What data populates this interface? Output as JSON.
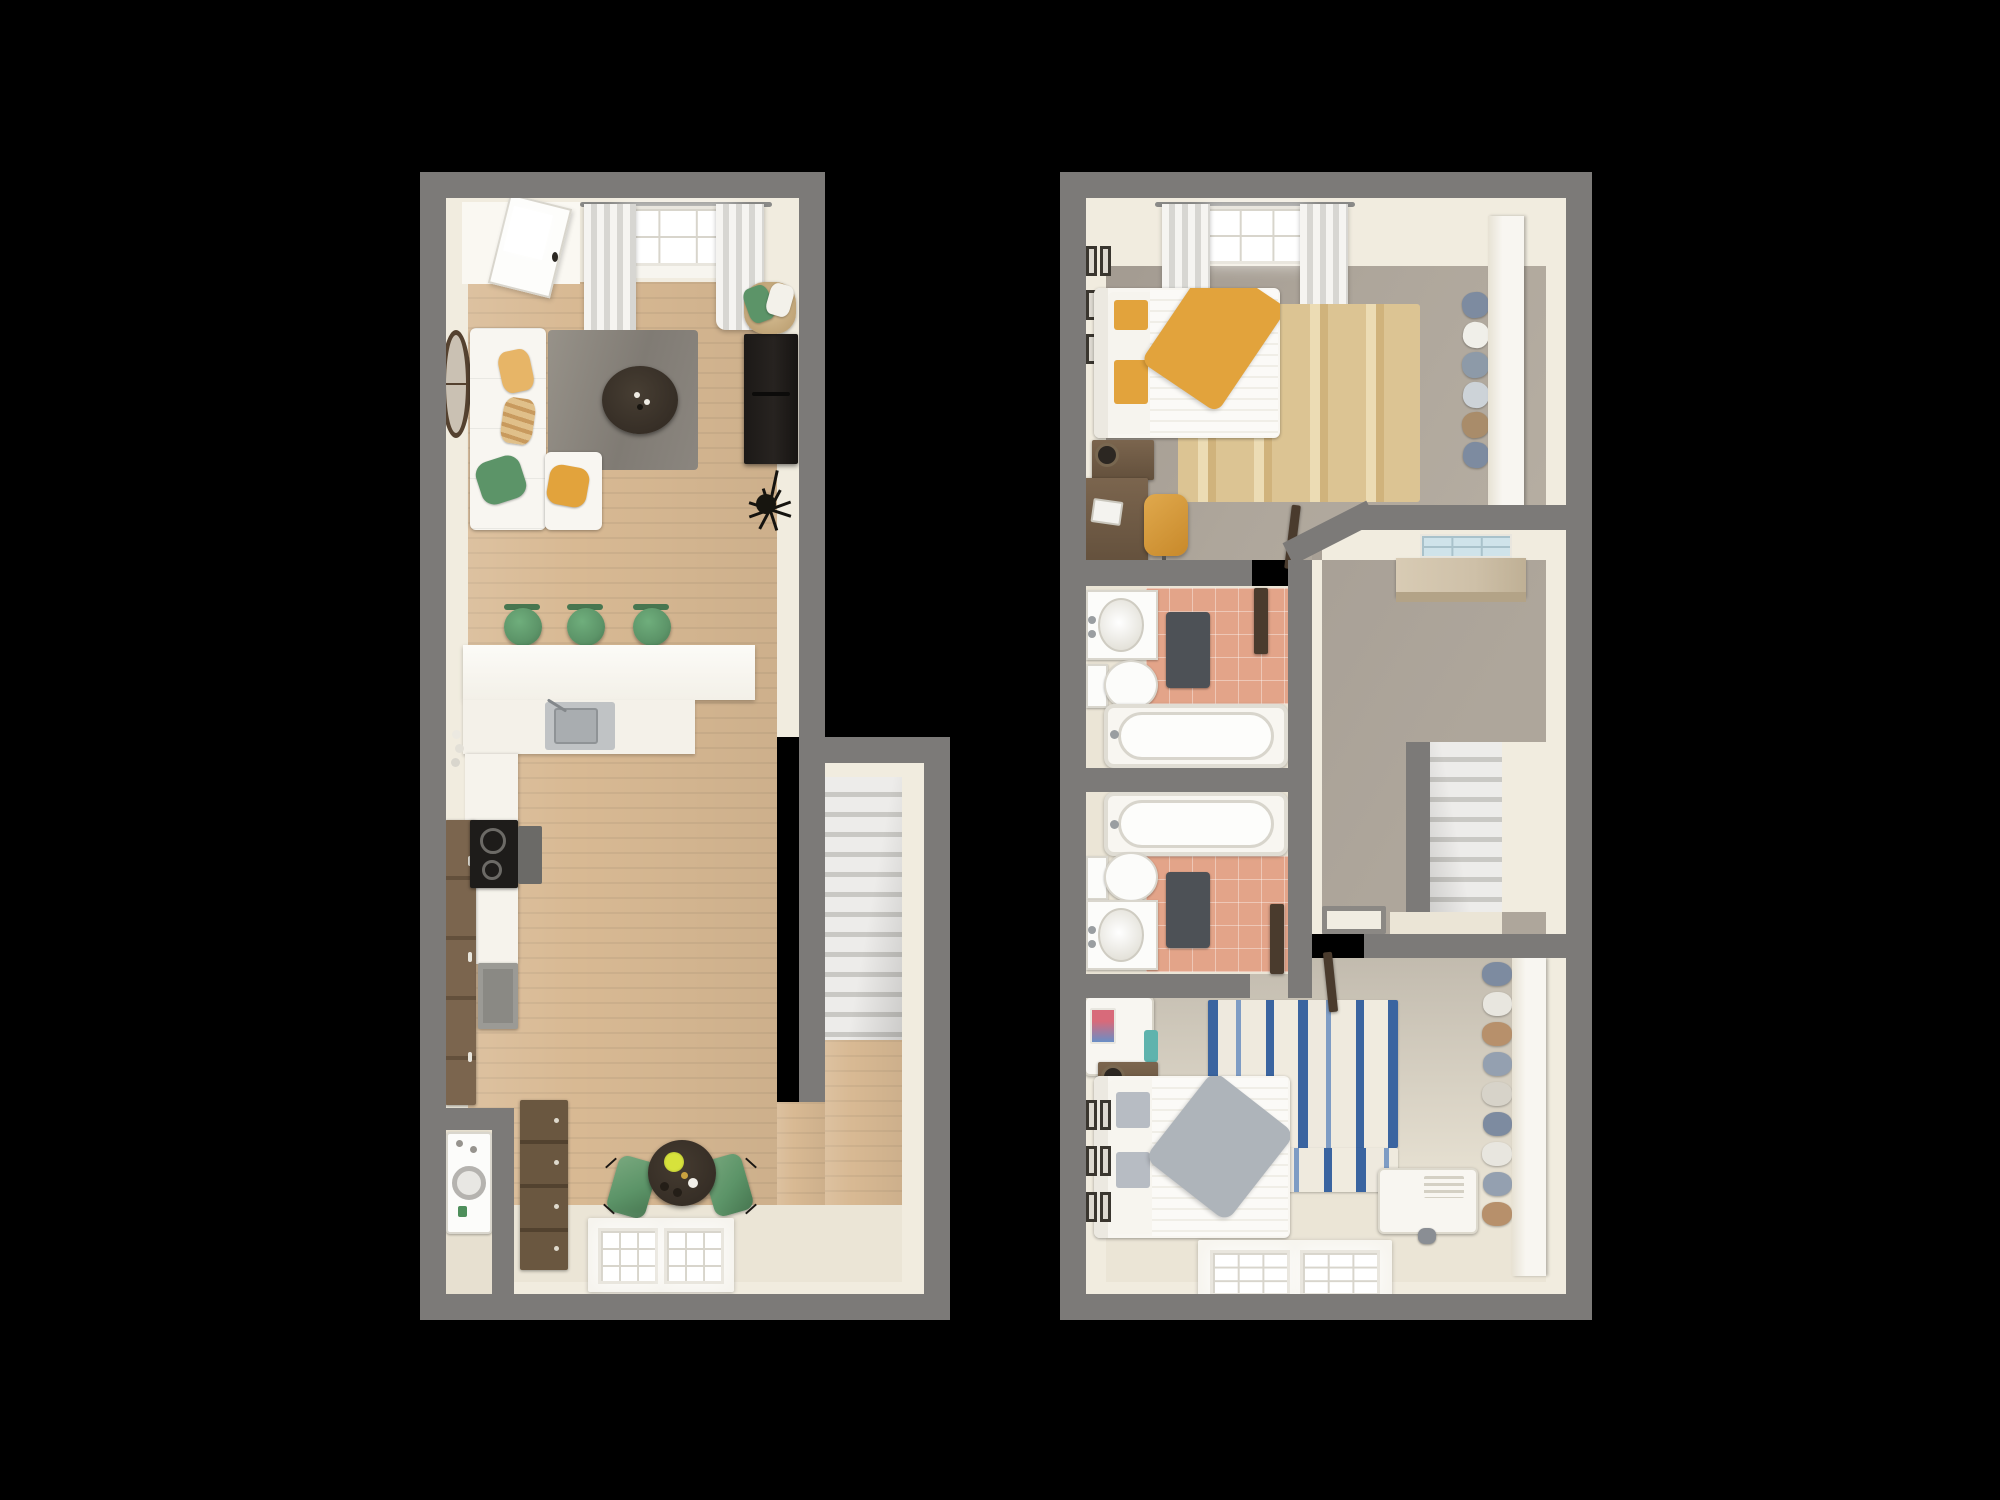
{
  "scene": {
    "type": "3d-floor-plan-top-view",
    "background": "black",
    "floors": [
      {
        "name": "first-floor",
        "stair_steps": 13,
        "rooms": [
          {
            "name": "living-room",
            "furniture": [
              "entry-door",
              "window-with-curtains",
              "wall-clock",
              "white-sectional-sofa",
              "throw-pillows",
              "gray-area-rug",
              "round-coffee-table",
              "media-console",
              "storage-basket-with-pillows",
              "spider-floor-lamp"
            ]
          },
          {
            "name": "kitchen",
            "furniture": [
              "l-shaped-breakfast-bar",
              "three-green-bar-stools",
              "stainless-sink",
              "black-cooktop",
              "tall-pantry-cabinet",
              "gray-base-cabinet"
            ]
          },
          {
            "name": "dining-area",
            "furniture": [
              "round-dining-table",
              "two-green-chairs",
              "place-settings",
              "wood-dresser",
              "window"
            ]
          },
          {
            "name": "utility-closet",
            "furniture": [
              "washer-unit"
            ]
          },
          {
            "name": "staircase",
            "furniture": [
              "stairs",
              "railing-wall"
            ]
          }
        ]
      },
      {
        "name": "second-floor",
        "stair_steps": 8,
        "rooms": [
          {
            "name": "bedroom-1",
            "furniture": [
              "bed-with-yellow-bedding",
              "pillows",
              "nightstand",
              "table-lamp",
              "desk-with-laptop",
              "mustard-desk-chair",
              "tan-striped-rug",
              "gallery-wall-frames",
              "window-with-curtains",
              "closet-with-hanging-clothes",
              "closet-partition",
              "open-door"
            ]
          },
          {
            "name": "bathroom-1",
            "furniture": [
              "vanity-sink",
              "toilet",
              "bathtub",
              "dark-bath-mat",
              "pink-tile-floor",
              "open-door"
            ]
          },
          {
            "name": "bathroom-2",
            "furniture": [
              "vanity-sink",
              "toilet",
              "bathtub",
              "dark-bath-mat",
              "pink-tile-floor",
              "open-door"
            ]
          },
          {
            "name": "hallway-landing",
            "furniture": [
              "transom-window",
              "built-in-shelf",
              "stairwell",
              "banister-wall",
              "floor-hatch"
            ]
          },
          {
            "name": "bedroom-2",
            "furniture": [
              "bed-with-gray-bedding",
              "pillows",
              "nightstand",
              "table-lamp",
              "desk-with-laptop",
              "blue-striped-rug",
              "gallery-wall-frames",
              "white-storage-chest",
              "shoe-closet",
              "closet-partition",
              "window",
              "open-door"
            ]
          }
        ]
      }
    ]
  },
  "colors": {
    "wallGray": "#7c7a78",
    "cream": "#f1ecdf",
    "creamDim": "#e7e0d0",
    "floorCream": "#ebe5d6",
    "woodMid": "#d8b993",
    "carpet": "#aea69b",
    "carpetLight": "#c2bbae",
    "tilePink": "#e3a489",
    "matDark": "#4d5156",
    "stairTread": "#edecea",
    "stairRiser": "#c9c8c4",
    "furnWhite": "#f8f6f1",
    "green": "#5c9468",
    "greenDark": "#477650",
    "mustard": "#e2a33c",
    "mustardDeep": "#c8892a",
    "blue": "#3a64a0",
    "rugTan": "#dcc493",
    "rugTanLight": "#ecdcb4",
    "rugGrayA": "#979289",
    "rugGrayB": "#807b74",
    "brown": "#7b654e",
    "brownDark": "#63503c",
    "tableDark": "#362e26",
    "consoleDark": "#272320",
    "steel": "#c0c3c5",
    "steelDark": "#a9adb0",
    "shelfTan": "#cec0a8",
    "glassBlue": "#cfe3ea",
    "glassGrid": "#a9c2cb",
    "teal": "#5fb3ad",
    "slate": "#7d8ba0",
    "doorBrown": "#4a3b2d",
    "winMullion": "#d8d5cc"
  }
}
